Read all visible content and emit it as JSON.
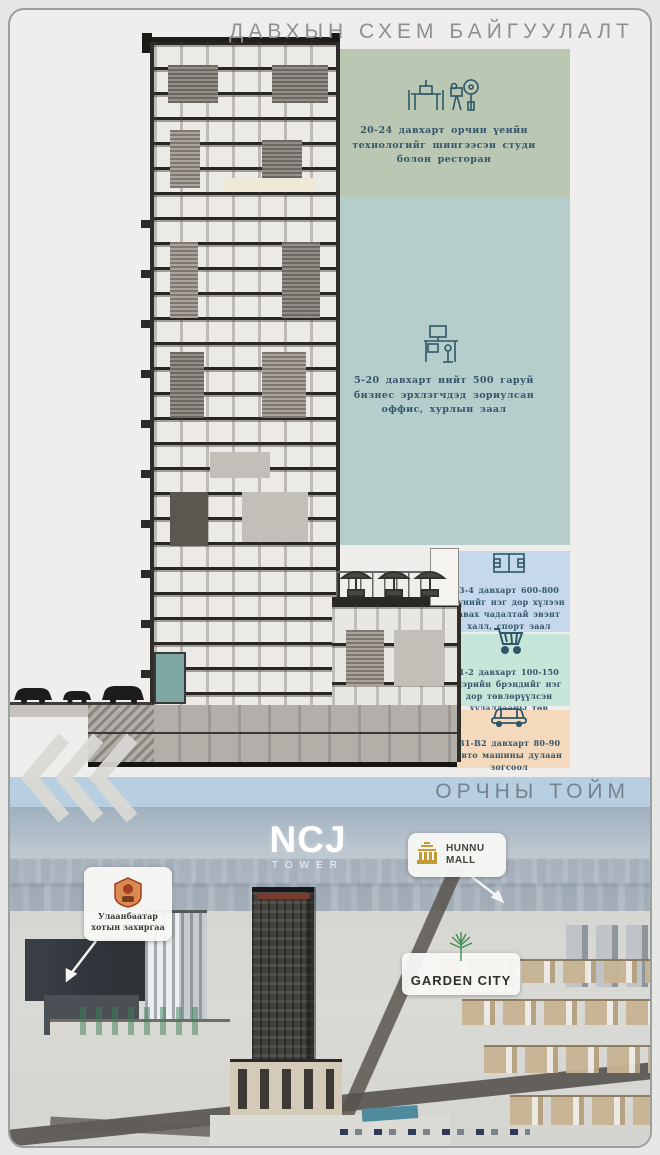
{
  "header": {
    "title": "ДАВХЫН СХЕМ БАЙГУУЛАЛТ"
  },
  "overview_header": {
    "title": "ОРЧНЫ ТОЙМ"
  },
  "floor_scheme": {
    "bands": [
      {
        "icon": "studio-restaurant",
        "color": "#b9c7b3",
        "label": "20-24 давхарт орчин үеийн технологийг шингээсэн студи болон ресторан"
      },
      {
        "icon": "office-desk",
        "color": "#b6cecb",
        "label": "5-20 давхарт нийт 500 гаруй бизнес эрхлэгчдэд зориулсан оффис, хурлын заал"
      },
      {
        "icon": "sport-hall",
        "color": "#c6d9ec",
        "label": "3-4 давхарт 600-800 хүнийг нэг дор хүлээн авах чадалтай эвэнт халл, спорт заал"
      },
      {
        "icon": "shopping-cart",
        "color": "#c6e6da",
        "label": "1-2 давхарт 100-150 нэрийн брэндийг нэг дор төвлөрүүлсэн худалдааны төв"
      },
      {
        "icon": "car",
        "color": "#f4d9bd",
        "label": "B1-B2 давхарт 80-90 авто машины дулаан зогсоол"
      }
    ]
  },
  "overview": {
    "tower_logo": {
      "name": "NCJ",
      "sub": "TOWER"
    },
    "labels": [
      {
        "id": "city-administration",
        "text": "Улаанбаатар хотын захиргаа"
      },
      {
        "id": "hunnu-mall",
        "text": "HUNNU MALL"
      },
      {
        "id": "garden-city",
        "text": "GARDEN CITY"
      }
    ]
  },
  "colors": {
    "accent_icon_stroke": "#2f5767",
    "overview_band": "#b7cfe0",
    "card_border": "#9aa09e"
  }
}
